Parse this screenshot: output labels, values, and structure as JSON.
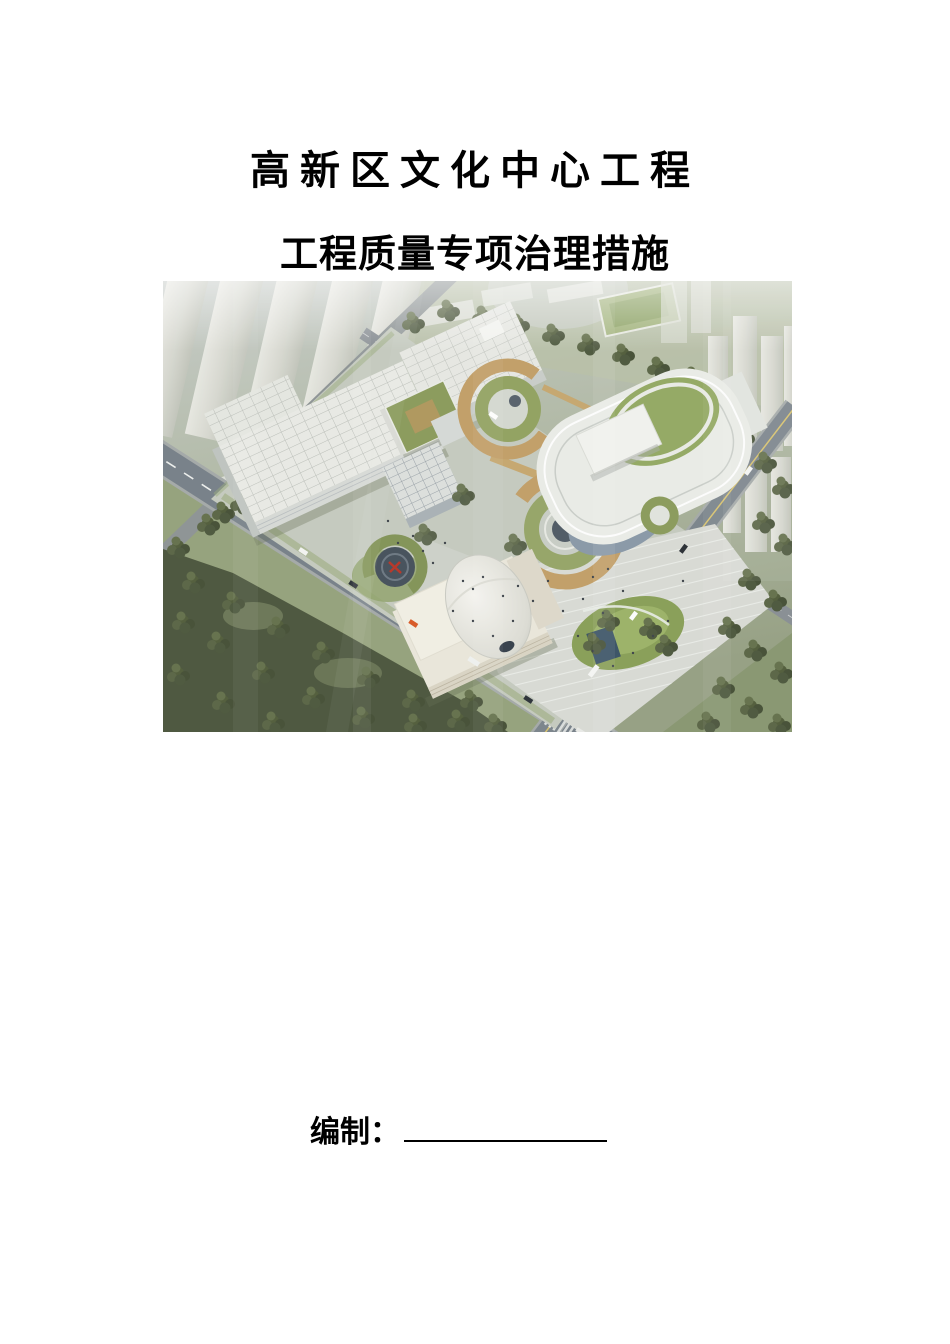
{
  "page": {
    "title_line1": "高新区文化中心工程",
    "title_line2": "工程质量专项治理措施",
    "author_label": "编制：",
    "author_value": ""
  },
  "rendering": {
    "name": "cultural-center-aerial-rendering",
    "palette": {
      "haze_gray": "#c7ccc9",
      "grass_green": "#96a37e",
      "forest_green": "#4f5941",
      "roof_green": "#8d9d5f",
      "ramp_tan": "#c2a06a",
      "building_white": "#e9ebe6",
      "glass_blue": "#8b9aa8",
      "road_gray": "#79828a",
      "pond_blue": "#3e5668",
      "accent_red": "#b8392b"
    }
  }
}
